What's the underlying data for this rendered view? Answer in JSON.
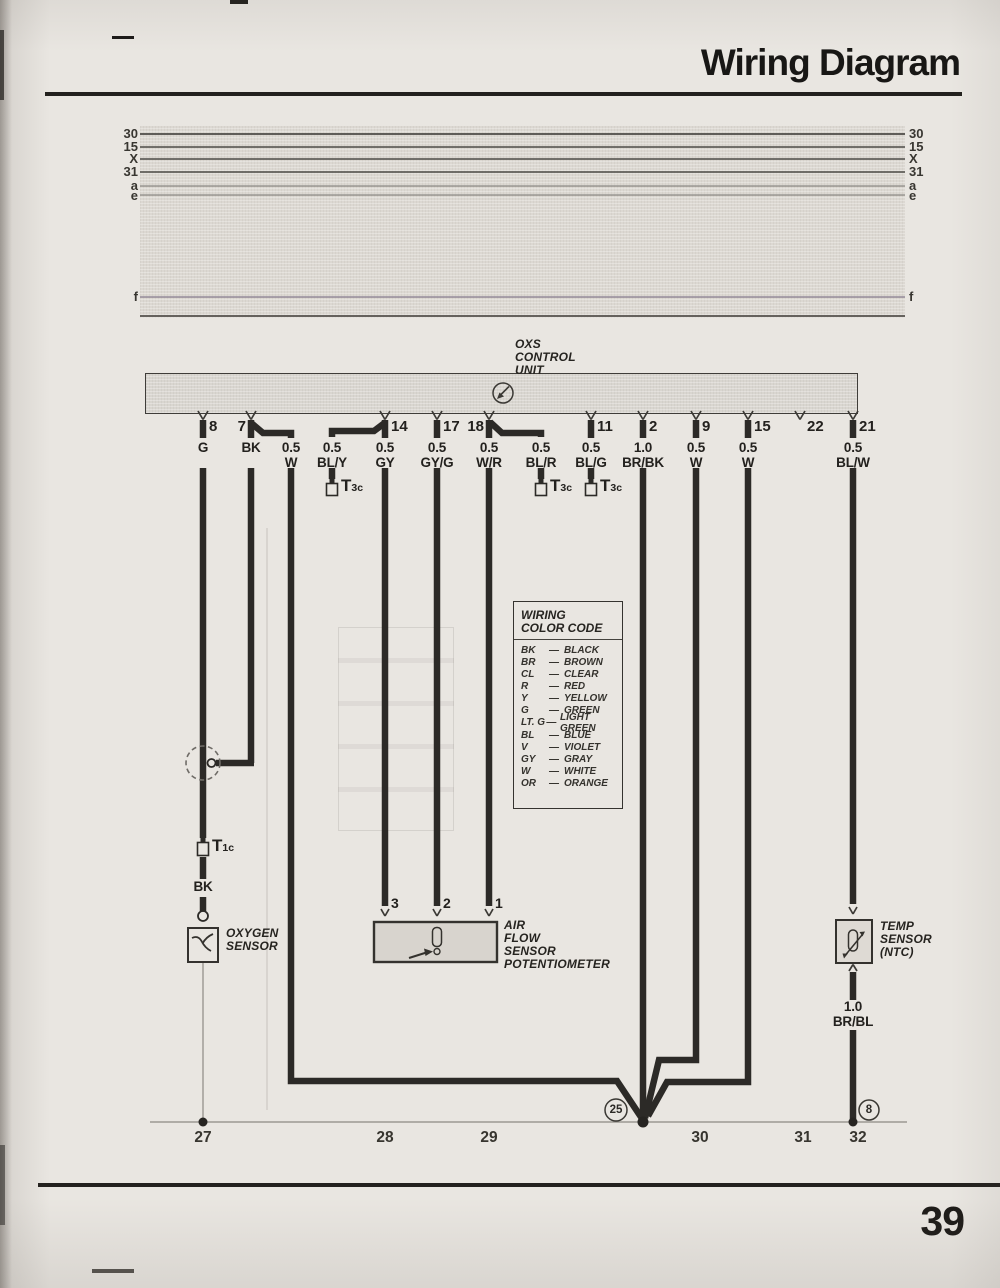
{
  "header": {
    "title": "Wiring Diagram",
    "page_number": "39"
  },
  "bus_labels": [
    "30",
    "15",
    "X",
    "31",
    "a",
    "e",
    "f"
  ],
  "control_unit": {
    "name_lines": [
      "OXS",
      "CONTROL",
      "UNIT"
    ]
  },
  "terminals": [
    {
      "number": "8",
      "gauge": "",
      "color": "G"
    },
    {
      "number": "7",
      "gauge": "",
      "color": "BK"
    },
    {
      "number": "",
      "gauge": "0.5",
      "color": "W"
    },
    {
      "number": "",
      "gauge": "0.5",
      "color": "BL/Y"
    },
    {
      "number": "14",
      "gauge": "0.5",
      "color": "GY"
    },
    {
      "number": "17",
      "gauge": "0.5",
      "color": "GY/G"
    },
    {
      "number": "18",
      "gauge": "0.5",
      "color": "W/R"
    },
    {
      "number": "",
      "gauge": "0.5",
      "color": "BL/R"
    },
    {
      "number": "11",
      "gauge": "0.5",
      "color": "BL/G"
    },
    {
      "number": "2",
      "gauge": "1.0",
      "color": "BR/BK"
    },
    {
      "number": "9",
      "gauge": "0.5",
      "color": "W"
    },
    {
      "number": "15",
      "gauge": "0.5",
      "color": "W"
    },
    {
      "number": "22",
      "gauge": "",
      "color": ""
    },
    {
      "number": "21",
      "gauge": "0.5",
      "color": "BL/W"
    }
  ],
  "connectors": {
    "t1c_main": "T",
    "t1c_sub": "1c",
    "t3c_main": "T",
    "t3c_sub": "3c"
  },
  "wire_labels": {
    "shield_bk": "BK",
    "temp_gauge": "1.0",
    "temp_color": "BR/BL"
  },
  "color_code": {
    "title_lines": [
      "WIRING",
      "COLOR CODE"
    ],
    "dash": "—",
    "entries": [
      {
        "abbr": "BK",
        "name": "BLACK"
      },
      {
        "abbr": "BR",
        "name": "BROWN"
      },
      {
        "abbr": "CL",
        "name": "CLEAR"
      },
      {
        "abbr": "R",
        "name": "RED"
      },
      {
        "abbr": "Y",
        "name": "YELLOW"
      },
      {
        "abbr": "G",
        "name": "GREEN"
      },
      {
        "abbr": "LT. G",
        "name": "LIGHT GREEN"
      },
      {
        "abbr": "BL",
        "name": "BLUE"
      },
      {
        "abbr": "V",
        "name": "VIOLET"
      },
      {
        "abbr": "GY",
        "name": "GRAY"
      },
      {
        "abbr": "W",
        "name": "WHITE"
      },
      {
        "abbr": "OR",
        "name": "ORANGE"
      }
    ]
  },
  "components": {
    "oxygen_sensor": {
      "name_lines": [
        "OXYGEN",
        "SENSOR"
      ]
    },
    "air_flow_sensor": {
      "name_lines": [
        "AIR",
        "FLOW",
        "SENSOR",
        "POTENTIOMETER"
      ],
      "terminal_numbers": [
        "3",
        "2",
        "1"
      ]
    },
    "temp_sensor": {
      "name_lines": [
        "TEMP",
        "SENSOR",
        "(NTC)"
      ]
    }
  },
  "ground_refs": {
    "left": "25",
    "right": "8"
  },
  "track_numbers": [
    "27",
    "28",
    "29",
    "30",
    "31",
    "32"
  ]
}
